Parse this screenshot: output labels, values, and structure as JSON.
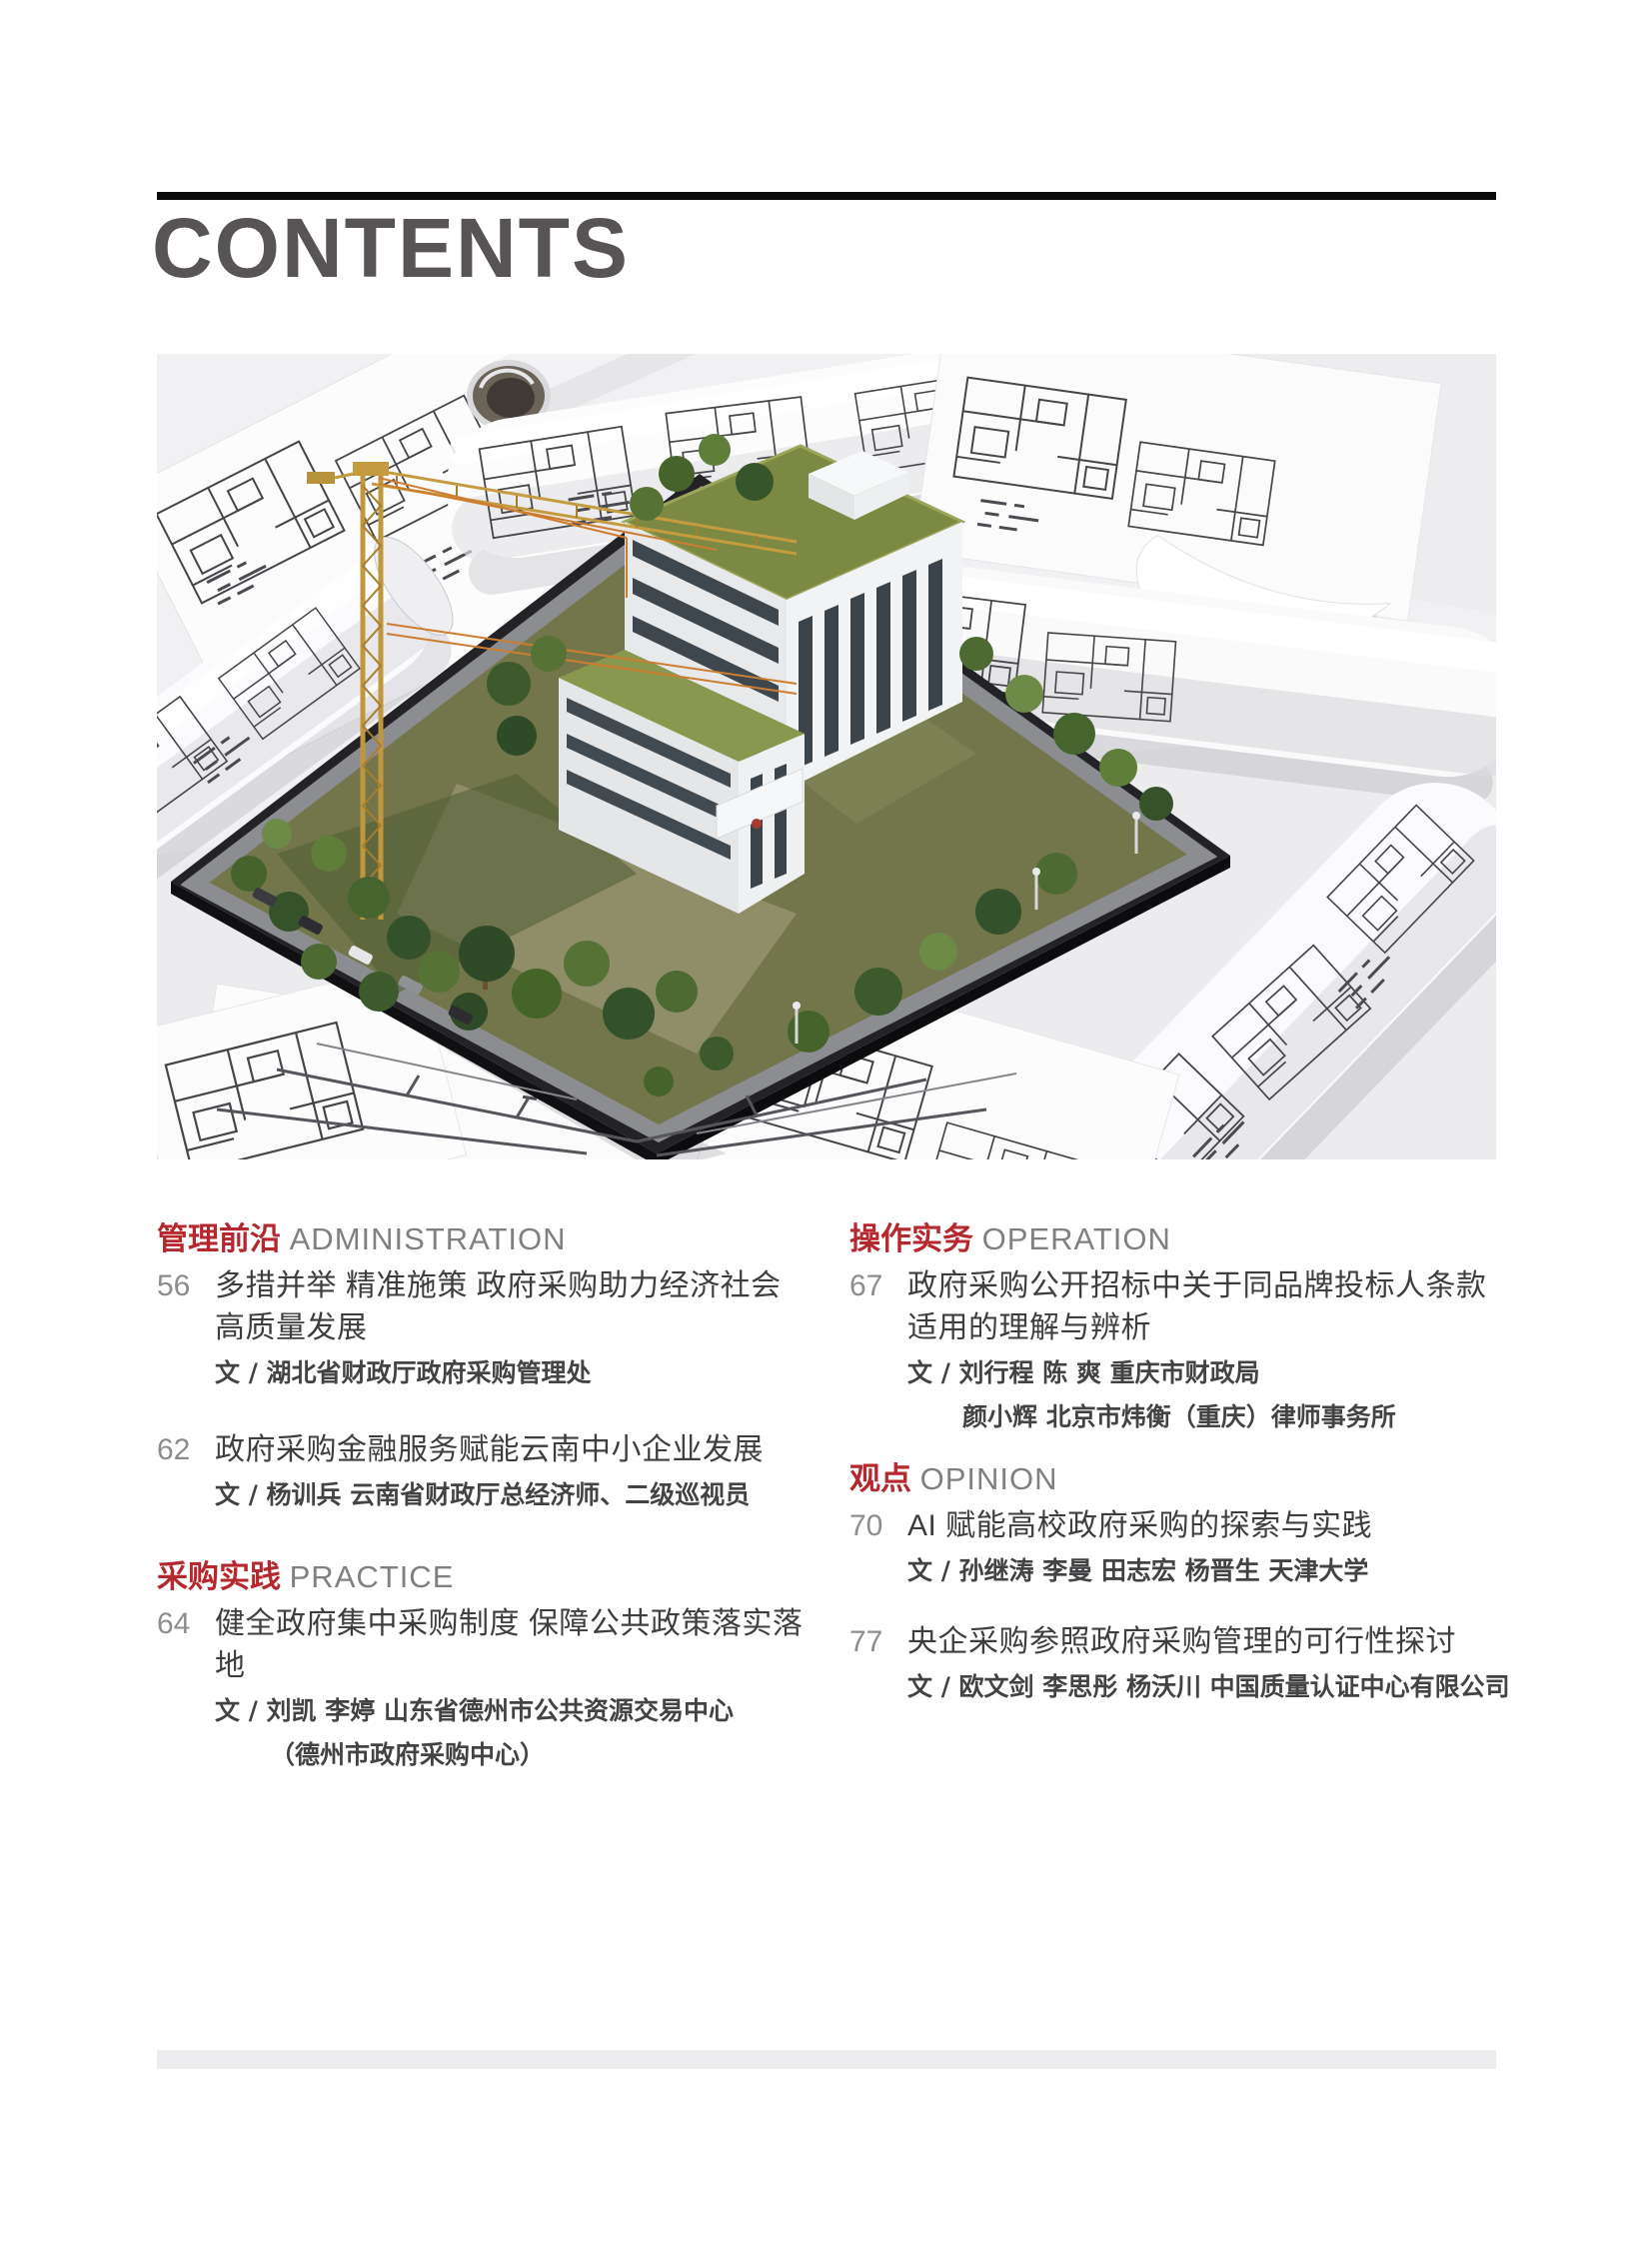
{
  "header": {
    "title": "CONTENTS"
  },
  "accent_color": "#b5282e",
  "hero_image": {
    "description": "Photo: architectural scale model of a white multi-storey building with green roofs and trees on a dark base plate, a yellow tower crane beside it, surrounded by rolled and flat blueprint floor-plan drawings on a light table."
  },
  "toc": {
    "left": {
      "sections": [
        {
          "zh": "管理前沿",
          "en": "ADMINISTRATION",
          "entries": [
            {
              "page": "56",
              "title": "多措并举 精准施策 政府采购助力经济社会高质量发展",
              "authors": [
                "文 / 湖北省财政厅政府采购管理处"
              ]
            },
            {
              "page": "62",
              "title": "政府采购金融服务赋能云南中小企业发展",
              "authors": [
                "文 / 杨训兵 云南省财政厅总经济师、二级巡视员"
              ]
            }
          ]
        },
        {
          "zh": "采购实践",
          "en": "PRACTICE",
          "entries": [
            {
              "page": "64",
              "title": "健全政府集中采购制度 保障公共政策落实落地",
              "authors": [
                "文 / 刘凯 李婷 山东省德州市公共资源交易中心",
                "（德州市政府采购中心）"
              ]
            }
          ]
        }
      ]
    },
    "right": {
      "sections": [
        {
          "zh": "操作实务",
          "en": "OPERATION",
          "entries": [
            {
              "page": "67",
              "title": "政府采购公开招标中关于同品牌投标人条款适用的理解与辨析",
              "authors": [
                "文 / 刘行程 陈 爽 重庆市财政局",
                "颜小辉 北京市炜衡（重庆）律师事务所"
              ]
            }
          ]
        },
        {
          "zh": "观点",
          "en": "OPINION",
          "entries": [
            {
              "page": "70",
              "title": "AI 赋能高校政府采购的探索与实践",
              "authors": [
                "文 / 孙继涛 李曼 田志宏 杨晋生 天津大学"
              ]
            },
            {
              "page": "77",
              "title": "央企采购参照政府采购管理的可行性探讨",
              "authors": [
                "文 / 欧文剑 李思彤 杨沃川 中国质量认证中心有限公司"
              ]
            }
          ]
        }
      ]
    }
  }
}
